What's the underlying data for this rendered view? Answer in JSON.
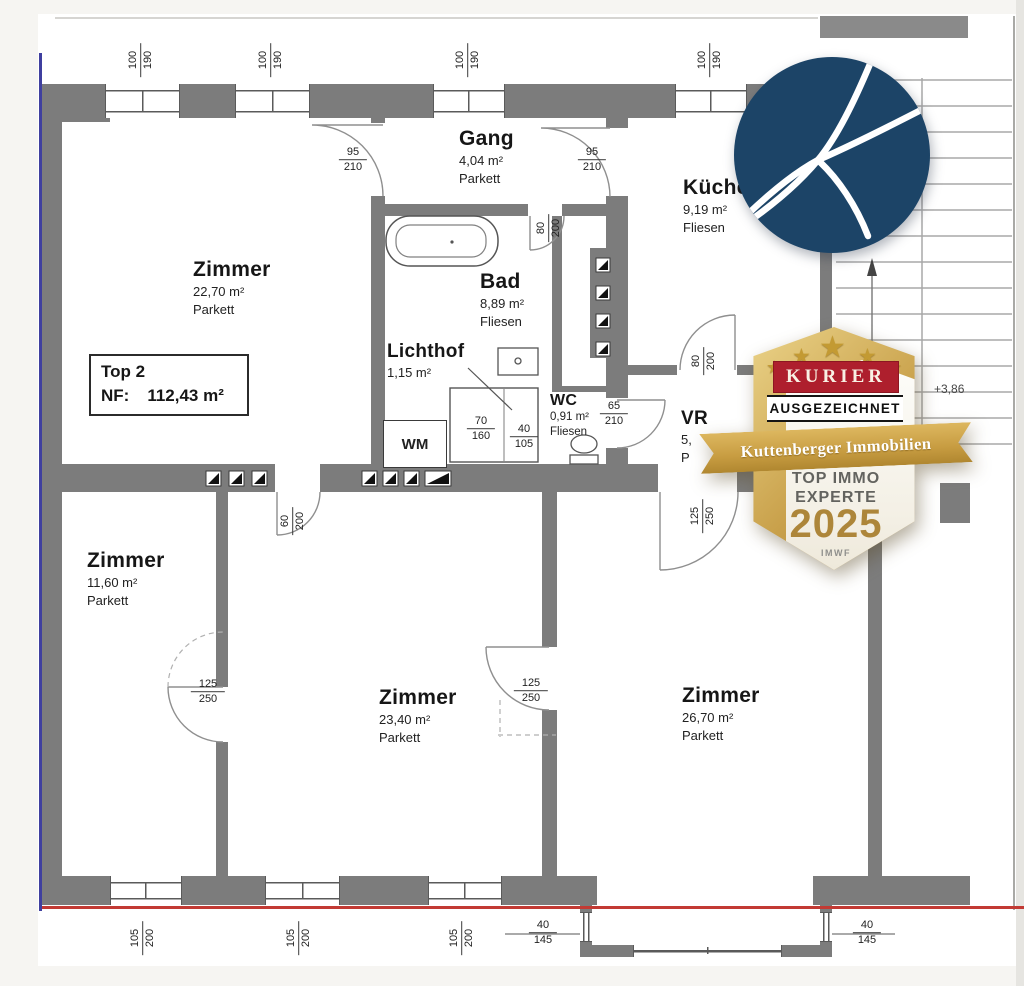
{
  "plan": {
    "unit": {
      "name": "Top 2",
      "nf_label": "NF:",
      "nf_value": "112,43 m²"
    },
    "rooms": {
      "zimmer_top": {
        "name": "Zimmer",
        "area": "22,70 m²",
        "floor": "Parkett"
      },
      "gang": {
        "name": "Gang",
        "area": "4,04 m²",
        "floor": "Parkett"
      },
      "bad": {
        "name": "Bad",
        "area": "8,89 m²",
        "floor": "Fliesen"
      },
      "kueche": {
        "name": "Küche",
        "area": "9,19 m²",
        "floor": "Fliesen"
      },
      "lichthof": {
        "name": "Lichthof",
        "area": "1,15 m²"
      },
      "wc": {
        "name": "WC",
        "area": "0,91 m²",
        "floor": "Fliesen"
      },
      "vr": {
        "name": "VR",
        "area": "5,",
        "floor": "P"
      },
      "zimmer_left": {
        "name": "Zimmer",
        "area": "11,60 m²",
        "floor": "Parkett"
      },
      "zimmer_mid": {
        "name": "Zimmer",
        "area": "23,40 m²",
        "floor": "Parkett"
      },
      "zimmer_right": {
        "name": "Zimmer",
        "area": "26,70 m²",
        "floor": "Parkett"
      }
    },
    "windows": {
      "top": [
        {
          "w": "100",
          "h": "190"
        },
        {
          "w": "100",
          "h": "190"
        },
        {
          "w": "100",
          "h": "190"
        },
        {
          "w": "100",
          "h": "190"
        }
      ],
      "bottom": [
        {
          "w": "105",
          "h": "200"
        },
        {
          "w": "105",
          "h": "200"
        },
        {
          "w": "105",
          "h": "200"
        }
      ],
      "bay": [
        {
          "w": "40",
          "h": "145"
        },
        {
          "w": "40",
          "h": "145"
        }
      ]
    },
    "doors": {
      "zimmer_gang": {
        "w": "95",
        "h": "210"
      },
      "gang_kueche": {
        "w": "95",
        "h": "210"
      },
      "bad": {
        "w": "80",
        "h": "200"
      },
      "kueche_vr": {
        "w": "80",
        "h": "200"
      },
      "wc_vr": {
        "w": "65",
        "h": "210"
      },
      "zimmer_60": {
        "w": "60",
        "h": "200"
      },
      "zimmer_left_125": {
        "w": "125",
        "h": "250"
      },
      "zimmer_mid_125": {
        "w": "125",
        "h": "250"
      },
      "vr_125": {
        "w": "125",
        "h": "250"
      }
    },
    "shaft": [
      {
        "w": "70",
        "h": "160"
      },
      {
        "w": "40",
        "h": "105"
      }
    ],
    "annotations": {
      "level": "+3,86",
      "wm": "WM"
    },
    "colors": {
      "wall": "#7c7c7c",
      "red_line": "#c23a34",
      "blue_line": "#3f3f9f"
    }
  },
  "logo": {
    "letter": "K",
    "color": "#1c4467"
  },
  "badge": {
    "stars": 5,
    "brand": "KURIER",
    "award": "AUSGEZEICHNET",
    "company": "Kuttenberger Immobilien",
    "title_line1": "TOP IMMO",
    "title_line2": "EXPERTE",
    "year": "2025",
    "source": "IMWF",
    "colors": {
      "gold": "#c9a14b",
      "red": "#ae1f2d"
    }
  }
}
